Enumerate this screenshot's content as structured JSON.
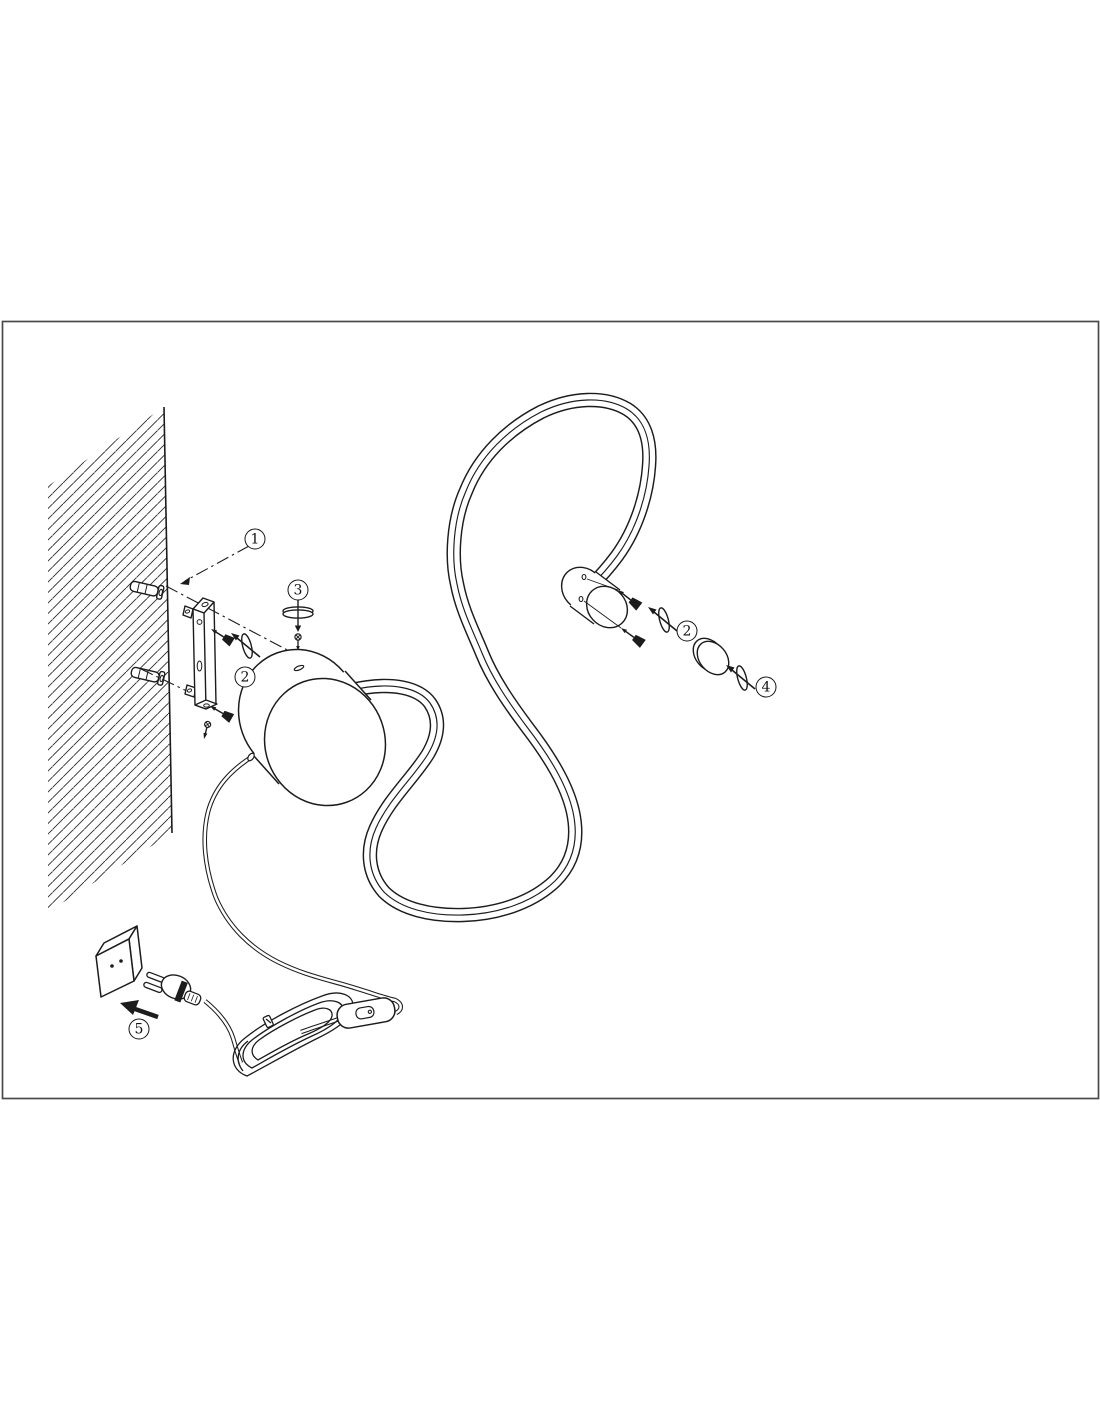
{
  "colors": {
    "background": "#ffffff",
    "ink": "#1c1c1c",
    "frame_border": "#4a4a4a"
  },
  "diagram": {
    "kind": "wall-lamp assembly instruction drawing",
    "callouts": [
      {
        "label": "1",
        "part": "wall-anchor"
      },
      {
        "label": "2",
        "part": "bracket-mounting-screws"
      },
      {
        "label": "3",
        "part": "base-locking-screw"
      },
      {
        "label": "2",
        "part": "tube-end-screws"
      },
      {
        "label": "4",
        "part": "end-cap-screw"
      },
      {
        "label": "5",
        "part": "plug-into-socket"
      }
    ]
  }
}
